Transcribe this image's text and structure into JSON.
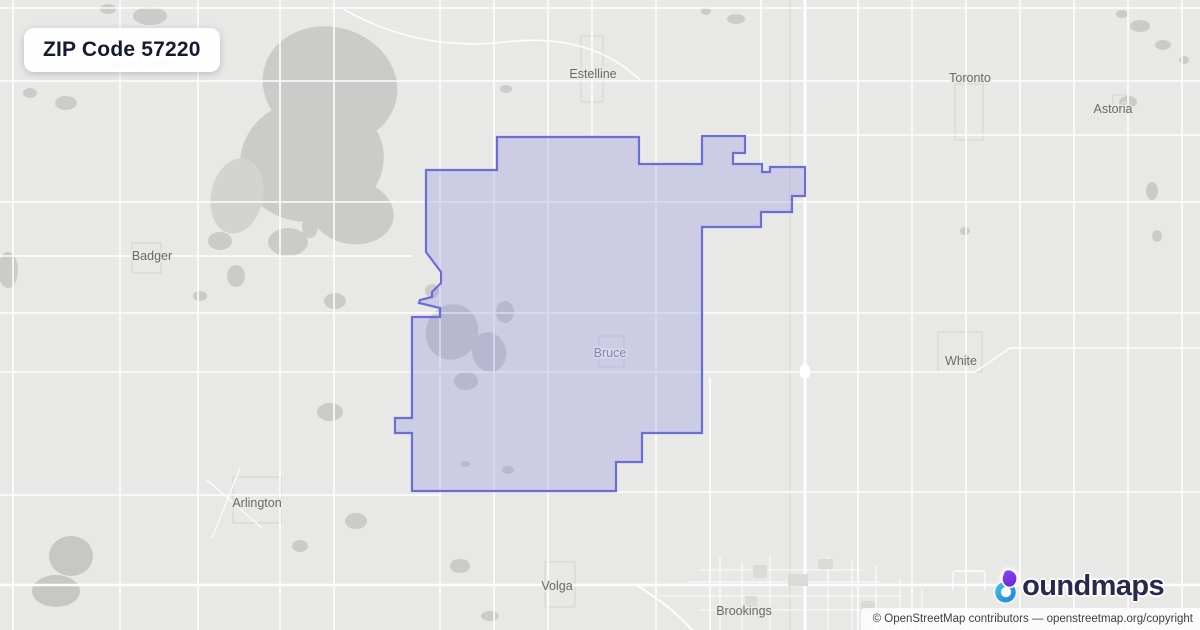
{
  "badge": {
    "title": "ZIP Code 57220"
  },
  "logo": {
    "brand": "boundmaps",
    "text_rest": "oundmaps",
    "purple": "#8a4bf0",
    "purple_dark": "#6d28d9",
    "teal": "#3ec6ec",
    "teal_dark": "#1f7fd4",
    "navy": "#262b4d"
  },
  "attribution": {
    "text": "© OpenStreetMap contributors — openstreetmap.org/copyright"
  },
  "zip": {
    "code": "57220",
    "fill": "#8a8fe2",
    "fill_opacity": 0.3,
    "stroke": "#6b6fd5",
    "stroke_width": 2.2,
    "points": "497,137 639,137 639,164 702,164 702,136 745,136 745,153 733,153 733,164 762,164 762,172 770,172 770,167 805,167 805,196 792,196 792,212 761,212 761,227 702,227 702,433 642,433 642,462 616,462 616,491 412,491 412,433 395,433 395,418 412,418 412,317 440,317 440,308 419,303 420,300 432,297 432,292 441,283 441,272 426,252 426,170 497,170"
  },
  "labels": [
    {
      "t": "Estelline",
      "x": 593,
      "y": 74
    },
    {
      "t": "Toronto",
      "x": 970,
      "y": 78
    },
    {
      "t": "Astoria",
      "x": 1113,
      "y": 109
    },
    {
      "t": "Badger",
      "x": 152,
      "y": 256
    },
    {
      "t": "Bruce",
      "x": 610,
      "y": 353,
      "c": "#858aa4",
      "h": "#d8daf1"
    },
    {
      "t": "White",
      "x": 961,
      "y": 361
    },
    {
      "t": "Arlington",
      "x": 257,
      "y": 503
    },
    {
      "t": "Volga",
      "x": 557,
      "y": 586
    },
    {
      "t": "Brookings",
      "x": 744,
      "y": 611
    },
    {
      "t": "Lake Norden",
      "x": 143,
      "y": 64,
      "c": "#a8a8a6"
    }
  ],
  "map": {
    "bg": "#e8e8e6",
    "road_color": "#fdfdfd",
    "water_color": "#cbcbc9",
    "label_color": "#6a6a68",
    "label_halo": "#e9e9e7",
    "blobs": [
      [
        330,
        85,
        68,
        58,
        15
      ],
      [
        312,
        160,
        72,
        62,
        -8
      ],
      [
        352,
        212,
        42,
        32,
        10
      ],
      [
        237,
        196,
        26,
        38,
        12,
        "#d3d3d1"
      ],
      [
        288,
        242,
        20,
        14,
        0
      ],
      [
        150,
        16,
        17,
        9
      ],
      [
        108,
        9,
        8,
        5
      ],
      [
        66,
        103,
        11,
        7
      ],
      [
        30,
        93,
        7,
        5
      ],
      [
        8,
        270,
        10,
        18
      ],
      [
        220,
        241,
        12,
        9
      ],
      [
        236,
        276,
        9,
        11
      ],
      [
        200,
        296,
        7,
        5
      ],
      [
        310,
        226,
        8,
        12
      ],
      [
        335,
        301,
        11,
        8
      ],
      [
        330,
        412,
        13,
        9
      ],
      [
        356,
        521,
        11,
        8
      ],
      [
        300,
        546,
        8,
        6
      ],
      [
        71,
        556,
        22,
        20,
        0,
        "#c7c7c5"
      ],
      [
        56,
        591,
        24,
        16,
        0,
        "#c7c7c5"
      ],
      [
        460,
        566,
        10,
        7
      ],
      [
        490,
        616,
        9,
        5
      ],
      [
        452,
        332,
        26,
        28,
        20
      ],
      [
        489,
        352,
        17,
        20,
        -15
      ],
      [
        505,
        312,
        9,
        11
      ],
      [
        466,
        381,
        12,
        9
      ],
      [
        432,
        291,
        7,
        7
      ],
      [
        508,
        470,
        6,
        4
      ],
      [
        465,
        464,
        5,
        3
      ],
      [
        506,
        89,
        6,
        4
      ],
      [
        1140,
        26,
        10,
        6
      ],
      [
        1163,
        45,
        8,
        5
      ],
      [
        1122,
        14,
        6,
        4
      ],
      [
        1184,
        60,
        5,
        4
      ],
      [
        1152,
        191,
        6,
        9
      ],
      [
        1157,
        236,
        5,
        6
      ],
      [
        965,
        231,
        5,
        4
      ],
      [
        1128,
        102,
        9,
        6
      ],
      [
        736,
        19,
        9,
        5
      ],
      [
        706,
        11,
        5,
        4
      ]
    ],
    "outlines": [
      [
        581,
        36,
        22,
        66
      ],
      [
        955,
        84,
        28,
        56
      ],
      [
        132,
        243,
        29,
        30
      ],
      [
        599,
        336,
        25,
        31
      ],
      [
        938,
        332,
        44,
        40
      ],
      [
        233,
        477,
        48,
        46
      ],
      [
        545,
        562,
        30,
        45
      ],
      [
        1113,
        95,
        16,
        14
      ]
    ],
    "roads": [
      {
        "l": [
          13,
          0,
          13,
          630
        ]
      },
      {
        "l": [
          120,
          0,
          120,
          630
        ]
      },
      {
        "l": [
          198,
          0,
          198,
          630
        ]
      },
      {
        "l": [
          280,
          0,
          280,
          630
        ]
      },
      {
        "l": [
          334,
          0,
          334,
          630
        ]
      },
      {
        "l": [
          440,
          0,
          440,
          630
        ]
      },
      {
        "l": [
          494,
          0,
          494,
          630
        ]
      },
      {
        "l": [
          548,
          0,
          548,
          630
        ]
      },
      {
        "l": [
          592,
          0,
          592,
          135
        ]
      },
      {
        "l": [
          656,
          0,
          656,
          630
        ]
      },
      {
        "l": [
          710,
          378,
          710,
          630
        ]
      },
      {
        "l": [
          761,
          0,
          761,
          170
        ]
      },
      {
        "l": [
          858,
          0,
          858,
          630
        ]
      },
      {
        "l": [
          912,
          0,
          912,
          630
        ]
      },
      {
        "l": [
          966,
          0,
          966,
          630
        ]
      },
      {
        "l": [
          1020,
          0,
          1020,
          630
        ]
      },
      {
        "l": [
          1074,
          0,
          1074,
          630
        ]
      },
      {
        "l": [
          1128,
          0,
          1128,
          630
        ]
      },
      {
        "l": [
          1182,
          0,
          1182,
          630
        ]
      },
      {
        "l": [
          790,
          0,
          790,
          630
        ],
        "w": 1,
        "c": "#d6d6d4"
      },
      {
        "l": [
          805,
          0,
          805,
          630
        ],
        "w": 3
      },
      {
        "l": [
          0,
          8,
          1200,
          8
        ]
      },
      {
        "l": [
          0,
          81,
          1200,
          81
        ]
      },
      {
        "l": [
          700,
          135,
          1200,
          135
        ]
      },
      {
        "l": [
          0,
          202,
          1200,
          202
        ]
      },
      {
        "l": [
          0,
          256,
          412,
          256
        ]
      },
      {
        "l": [
          0,
          313,
          1200,
          313
        ]
      },
      {
        "l": [
          0,
          372,
          975,
          372
        ]
      },
      {
        "l": [
          1010,
          348,
          1200,
          348
        ]
      },
      {
        "d": "M975,372 L1010,348"
      },
      {
        "l": [
          0,
          495,
          440,
          495
        ]
      },
      {
        "l": [
          616,
          492,
          1200,
          492
        ]
      },
      {
        "l": [
          0,
          585,
          1200,
          585
        ],
        "w": 2.6
      },
      {
        "d": "M345,10 Q420,52 505,42 T640,80"
      },
      {
        "d": "M207,480 L262,528",
        "w": 1.2
      },
      {
        "d": "M240,468 L212,538",
        "w": 1.2
      },
      {
        "d": "M638,586 C660,600 676,612 692,630",
        "w": 2
      },
      {
        "l": [
          700,
          570,
          862,
          570
        ],
        "w": 1.1
      },
      {
        "l": [
          688,
          582,
          880,
          582
        ],
        "w": 1.1
      },
      {
        "l": [
          660,
          596,
          902,
          596
        ],
        "w": 1.1
      },
      {
        "l": [
          700,
          610,
          922,
          610
        ],
        "w": 1.1
      },
      {
        "l": [
          860,
          622,
          1005,
          622
        ],
        "w": 1.1
      },
      {
        "l": [
          720,
          558,
          720,
          630
        ],
        "w": 1.1
      },
      {
        "l": [
          742,
          562,
          742,
          630
        ],
        "w": 1.1
      },
      {
        "l": [
          770,
          556,
          770,
          630
        ],
        "w": 1.1
      },
      {
        "l": [
          828,
          556,
          828,
          630
        ],
        "w": 1.1
      },
      {
        "l": [
          852,
          560,
          852,
          630
        ],
        "w": 1.1
      },
      {
        "l": [
          876,
          566,
          876,
          630
        ],
        "w": 1.1
      },
      {
        "l": [
          900,
          580,
          900,
          630
        ],
        "w": 1.1
      },
      {
        "l": [
          922,
          590,
          922,
          630
        ],
        "w": 1.1
      },
      {
        "d": "M953,590 v-16 a3,3 0 0 1 3,-3 h26 a3,3 0 0 1 3,3 v16",
        "w": 1.4
      }
    ],
    "blocks": [
      [
        753,
        565,
        14,
        13,
        "#dadad8",
        0
      ],
      [
        788,
        574,
        20,
        12,
        "#dadad8",
        0
      ],
      [
        818,
        559,
        15,
        10,
        "#dadad8",
        0
      ],
      [
        745,
        596,
        12,
        10,
        "#dadad8",
        0
      ],
      [
        861,
        601,
        14,
        10,
        "#dadad8",
        0
      ],
      [
        800,
        364,
        10,
        15,
        "#ffffff",
        5
      ]
    ]
  }
}
